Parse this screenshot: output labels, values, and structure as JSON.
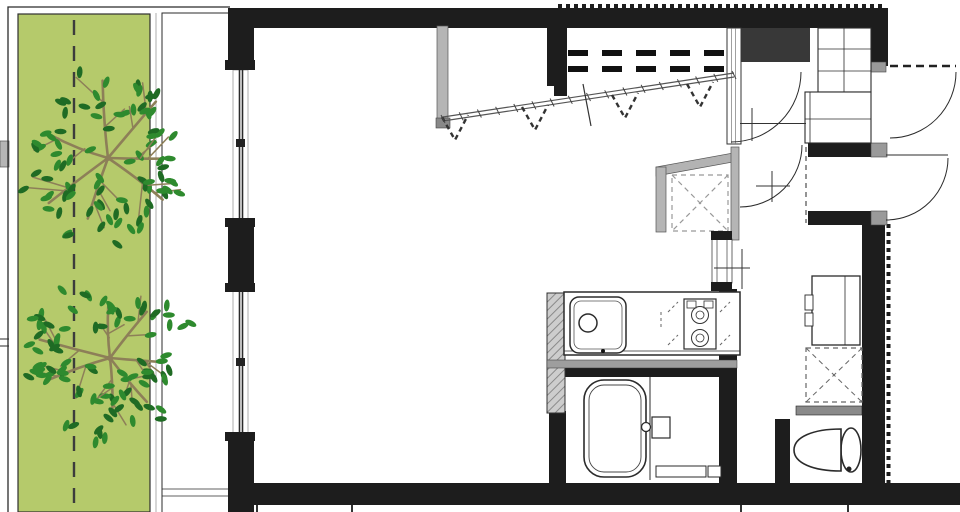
{
  "document": {
    "kind": "architectural-floor-plan",
    "description": "one-room apartment plan with side garden and balcony",
    "visible_text": []
  },
  "colors": {
    "lawn": "#b5ca6b",
    "leaf": "#2e8a2e",
    "leafd": "#1f6b24",
    "branch": "#8d7f58",
    "wall": "#1d1d1d",
    "graywall": "#b5b5b5",
    "line": "#2b2b2b"
  },
  "areas": [
    "garden-strip",
    "balcony",
    "living-room",
    "wardrobe-area",
    "kitchen",
    "bathroom",
    "washroom",
    "toilet-room",
    "entry-hall",
    "trunk-room",
    "corridor"
  ],
  "fixtures": [
    "tree",
    "property-dashed-line",
    "sliding-window",
    "wardrobe-rail",
    "clothes-hanger-marks",
    "overhead-shelf-dashed",
    "storage-cross-box",
    "kitchen-counter",
    "kitchen-sink",
    "sink-faucet",
    "gas-stove",
    "bathtub",
    "bath-control-box",
    "washbasin-vanity",
    "washing-machine-space",
    "wall-shelf",
    "toilet",
    "shoe-cabinet",
    "entry-side-cabinet",
    "door-swing-arc",
    "entrance-door-dashed",
    "sliding-door",
    "trunk-room-door"
  ]
}
